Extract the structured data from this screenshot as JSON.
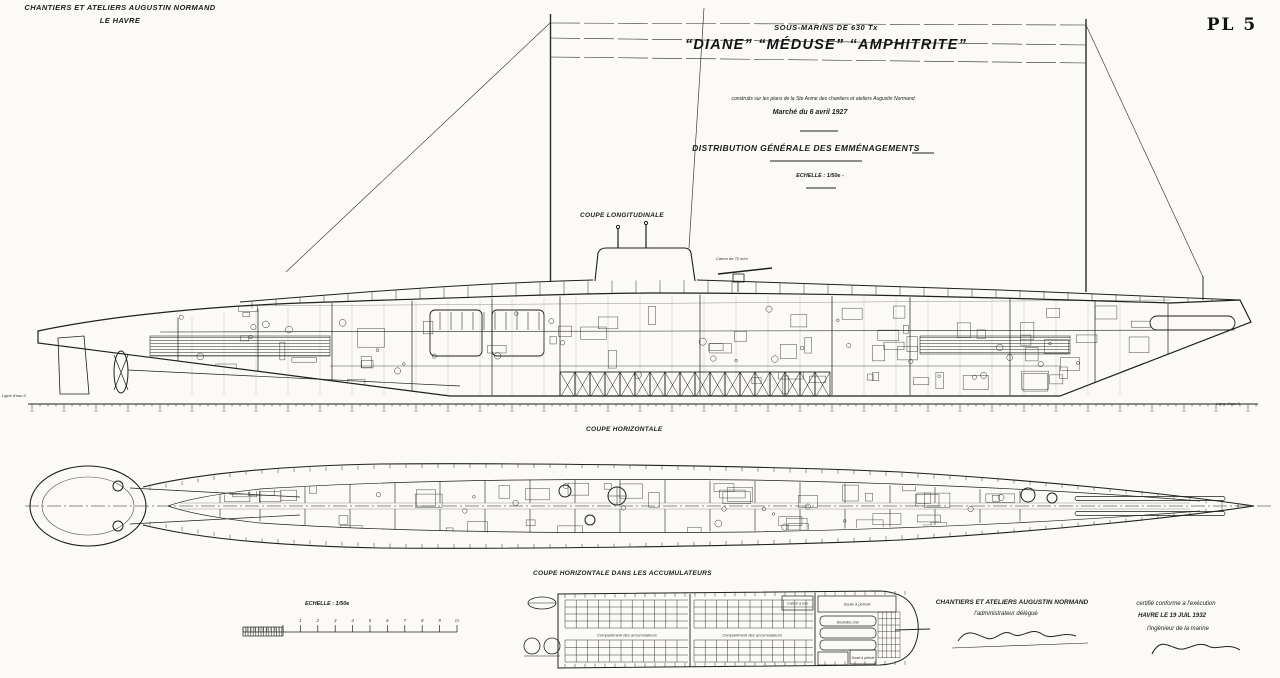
{
  "sheet": {
    "company": {
      "line1": "CHANTIERS ET ATELIERS AUGUSTIN NORMAND",
      "line2": "LE HAVRE"
    },
    "plate": "PL 5"
  },
  "title_block": {
    "class_line": "SOUS-MARINS DE 630 Tx",
    "ship_names": "“DIANE” “MÉDUSE” “AMPHITRITE”",
    "built_line": "construits sur les plans de la Ste Anme des chantiers et ateliers Augustin Normand",
    "contract_line": "Marché du 6 avril 1927",
    "drawing_title": "DISTRIBUTION GÉNÉRALE DES EMMÉNAGEMENTS",
    "scale_line": "ECHELLE : 1/50e -"
  },
  "section_labels": {
    "longitudinal": "COUPE LONGITUDINALE",
    "horizontal": "COUPE HORIZONTALE",
    "accumulators": "COUPE HORIZONTALE DANS LES ACCUMULATEURS"
  },
  "annotations": {
    "gun": "Canon de 75 m/m",
    "waterline_left": "Ligne d'eau 0",
    "waterline_right": "Ligne d'eau 0",
    "acc_compartment_1": "Compartiment des accumulateurs",
    "acc_compartment_2": "Compartiment des accumulateurs",
    "water_tank": "Caisse à eau",
    "air_flasks": "Bouteilles d'air",
    "fuel_tank": "Soute à pétrole",
    "fuel_tank_2": "Soute à pétrole"
  },
  "scale_bar": {
    "label": "ECHELLE : 1/50e",
    "tick_labels": [
      "1",
      "2",
      "3",
      "4",
      "5",
      "6",
      "7",
      "8",
      "9",
      "m"
    ]
  },
  "signatures": {
    "builder": {
      "line1": "CHANTIERS ET ATELIERS AUGUSTIN NORMAND",
      "line2": "l'administrateur délégué"
    },
    "certification": {
      "line1": "certifié conforme a l'exécution",
      "line2": "HAVRE LE 19 JUIL 1932",
      "line3": "l'ingénieur de la marine"
    }
  }
}
